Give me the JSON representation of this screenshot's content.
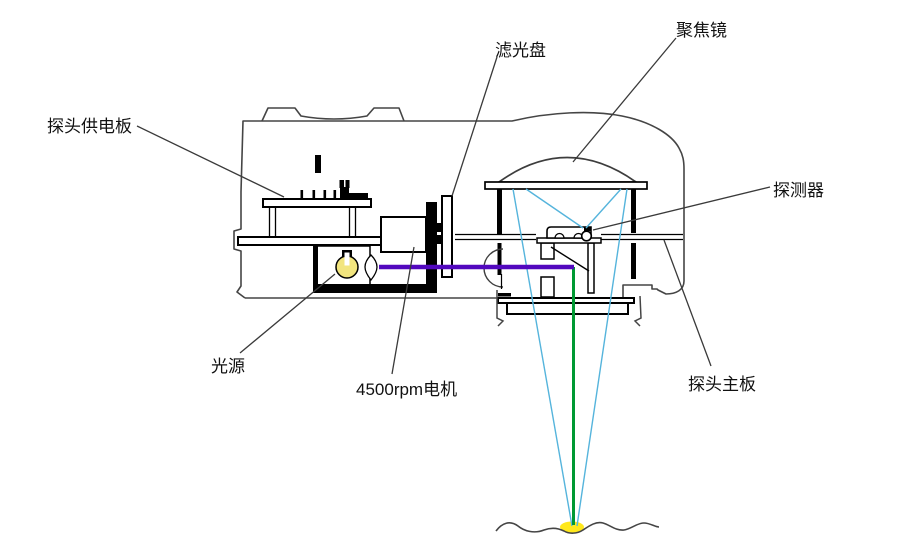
{
  "diagram": {
    "labels": {
      "power_board": "探头供电板",
      "filter_disk": "滤光盘",
      "focusing_lens": "聚焦镜",
      "detector": "探测器",
      "light_source": "光源",
      "motor": "4500rpm电机",
      "main_board": "探头主板"
    },
    "colors": {
      "beam_purple": "#5208be",
      "ray_cyan": "#55b4dc",
      "beam_green": "#009933",
      "bulb_yellow": "#f2e57e",
      "spot_yellow": "#ffe81c",
      "outline_gray": "#454545",
      "component_black": "#000000",
      "background": "#ffffff"
    }
  }
}
